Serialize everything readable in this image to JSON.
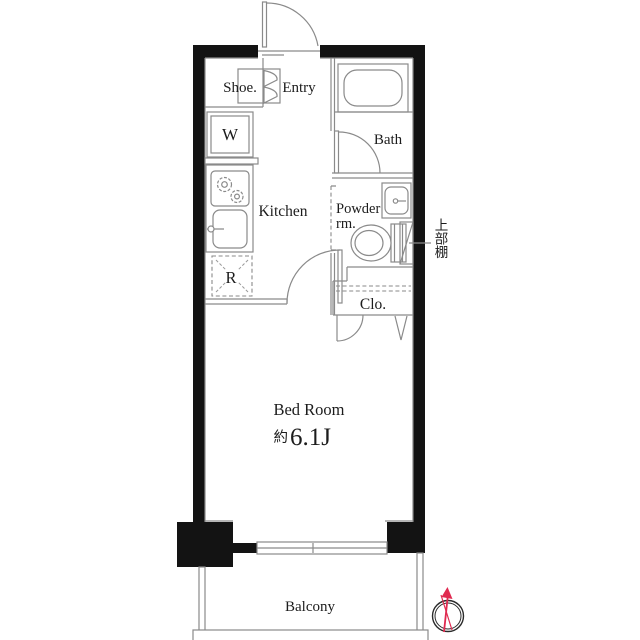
{
  "plan": {
    "rooms": {
      "shoe": {
        "label": "Shoe."
      },
      "entry": {
        "label": "Entry"
      },
      "bath": {
        "label": "Bath"
      },
      "kitchen": {
        "label": "Kitchen"
      },
      "powder": {
        "label_line1": "Powder",
        "label_line2": "rm."
      },
      "upper_shelf": {
        "label": "上部棚"
      },
      "closet": {
        "label": "Clo."
      },
      "bedroom": {
        "label": "Bed Room",
        "area_prefix": "約",
        "area_value": "6.1J"
      },
      "balcony": {
        "label": "Balcony"
      }
    },
    "fixtures": {
      "washer_label": "W",
      "refrigerator_label": "R"
    },
    "colors": {
      "wall": "#131313",
      "line": "#8a8a8a",
      "text": "#1c1c1c",
      "compass_needle": "#e02a50",
      "background": "#ffffff"
    }
  }
}
